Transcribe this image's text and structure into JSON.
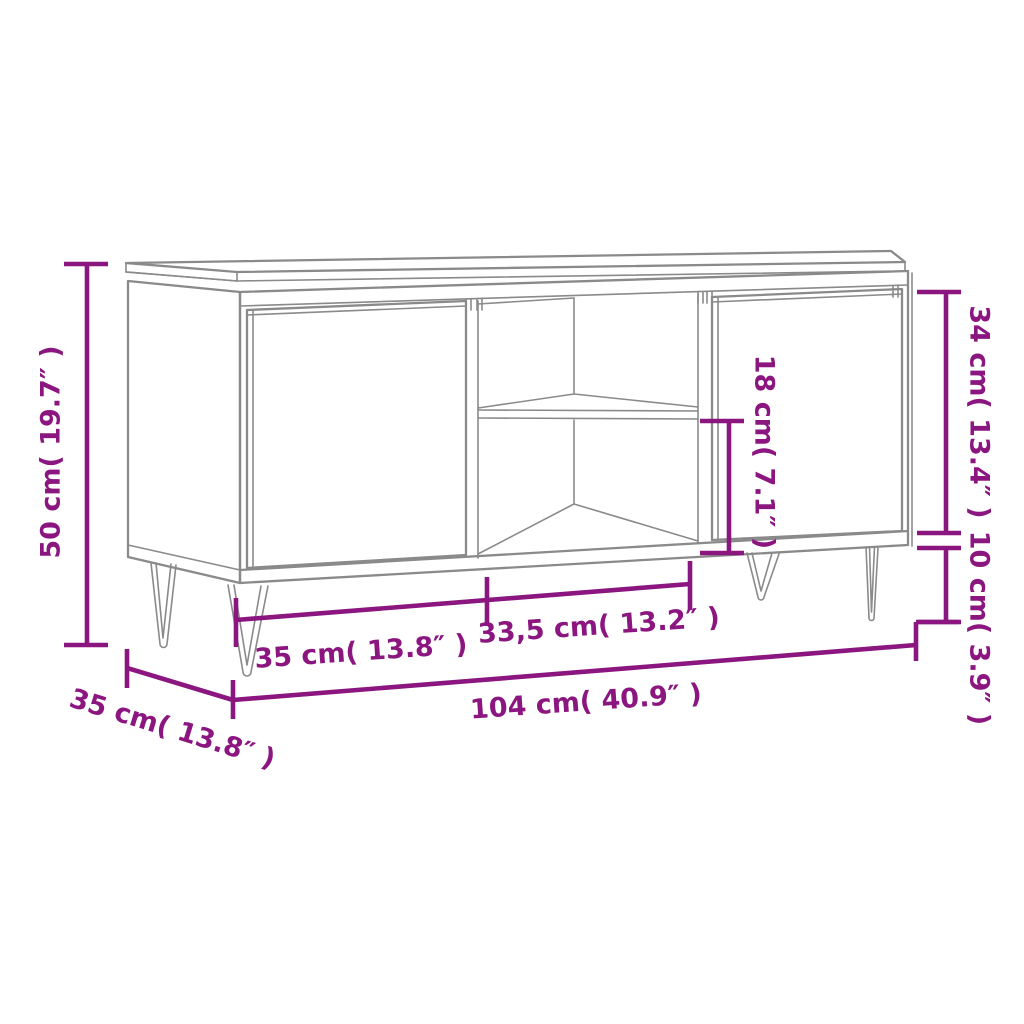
{
  "page": {
    "title": "TV cabinet dimension diagram",
    "background": "#ffffff"
  },
  "colors": {
    "dimension_accent": "#8B1680",
    "drawing_line": "#8A8A8A"
  },
  "diagram": {
    "description": "Line drawing of a TV cabinet with two doors, an open middle shelf section and hairpin legs, annotated with purple dimension lines",
    "labels": {
      "overall_height": "50 cm( 19.7″ )",
      "depth": "35 cm( 13.8″ )",
      "left_door_width": "35 cm( 13.8″ )",
      "middle_section_width": "33,5 cm( 13.2″ )",
      "overall_width": "104 cm( 40.9″ )",
      "lower_compartment_height": "18 cm( 7.1″ )",
      "door_height": "34 cm( 13.4″ )",
      "leg_height": "10 cm( 3.9″ )"
    },
    "measurements": [
      {
        "id": "overall_height",
        "cm": "50",
        "inches": "19.7"
      },
      {
        "id": "depth",
        "cm": "35",
        "inches": "13.8"
      },
      {
        "id": "left_door_width",
        "cm": "35",
        "inches": "13.8"
      },
      {
        "id": "middle_section_width",
        "cm": "33,5",
        "inches": "13.2"
      },
      {
        "id": "overall_width",
        "cm": "104",
        "inches": "40.9"
      },
      {
        "id": "lower_compartment_height",
        "cm": "18",
        "inches": "7.1"
      },
      {
        "id": "door_height",
        "cm": "34",
        "inches": "13.4"
      },
      {
        "id": "leg_height",
        "cm": "10",
        "inches": "3.9"
      }
    ]
  }
}
